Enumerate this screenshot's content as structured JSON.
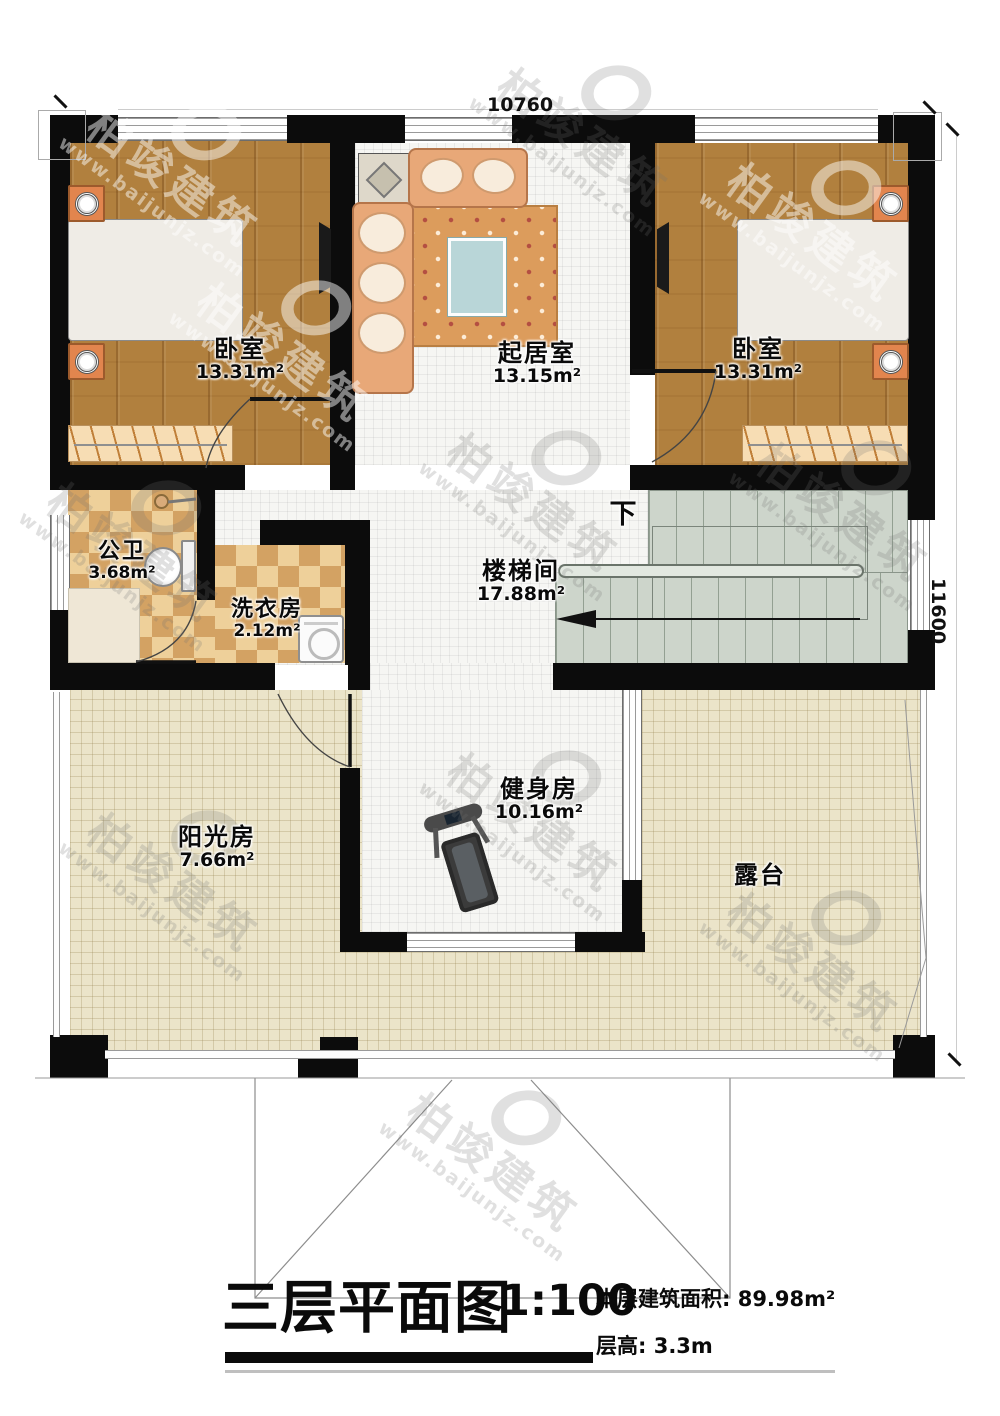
{
  "title_block": {
    "title": "三层平面图",
    "scale": "1:100",
    "area_line": "本层建筑面积: 89.98m²",
    "height_line": "层高: 3.3m"
  },
  "dimensions": {
    "top": "10760",
    "right": "11600"
  },
  "stair": {
    "down_label": "下"
  },
  "rooms": [
    {
      "id": "bedroom-left",
      "name": "卧室",
      "area": "13.31m²"
    },
    {
      "id": "living-room",
      "name": "起居室",
      "area": "13.15m²"
    },
    {
      "id": "bedroom-right",
      "name": "卧室",
      "area": "13.31m²"
    },
    {
      "id": "bathroom",
      "name": "公卫",
      "area": "3.68m²"
    },
    {
      "id": "laundry",
      "name": "洗衣房",
      "area": "2.12m²"
    },
    {
      "id": "stairwell",
      "name": "楼梯间",
      "area": "17.88m²"
    },
    {
      "id": "gym",
      "name": "健身房",
      "area": "10.16m²"
    },
    {
      "id": "sunroom",
      "name": "阳光房",
      "area": "7.66m²"
    },
    {
      "id": "terrace",
      "name": "露台",
      "area": ""
    }
  ],
  "watermark": {
    "cn": "柏竣建筑",
    "url": "www.baijunjz.com"
  },
  "colors": {
    "wall": "#0c0c0c",
    "wood_floor": "#b1803e",
    "white_tile": "#f6f6f3",
    "terrace_floor": "#ebe4c9",
    "bath_tile_light": "#eed09a",
    "bath_tile_dark": "#d3a263",
    "stair": "#cdd5cb",
    "bed_blue": "#57b4d8",
    "sofa_tan": "#e8a878"
  }
}
